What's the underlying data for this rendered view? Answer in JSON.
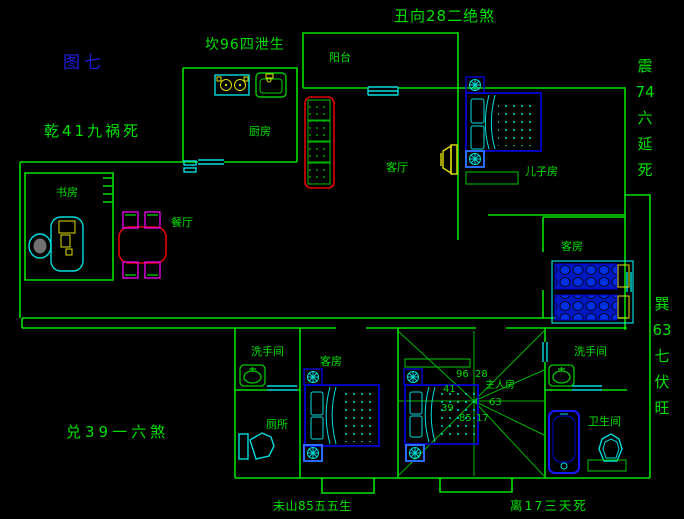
{
  "annotations": {
    "top_center": "丑向28二绝煞",
    "figure_label": "图七",
    "kan_north": "坎96四泄生",
    "qian_northwest": "乾41九祸死",
    "zhen_east": "震\n74\n六\n延\n死",
    "xun_southeast": "巽\n63\n七\n伏\n旺",
    "dui_west": "兑39一六煞",
    "wei_south_left": "未山85五五生",
    "li_south_right": "离17三天死"
  },
  "rooms": {
    "balcony": "阳台",
    "kitchen": "厨房",
    "living_room": "客厅",
    "son_room": "儿子房",
    "study": "书房",
    "dining": "餐厅",
    "guest_room_east": "客房",
    "washroom_left": "洗手间",
    "guest_room_south": "客房",
    "toilet": "厕所",
    "master_room": "主人房",
    "washroom_right": "洗手间",
    "bathroom": "卫生间"
  },
  "compass_numbers": {
    "nw": "96",
    "n": "28",
    "w_upper": "41",
    "w_lower": "39",
    "sw": "85",
    "s": "17",
    "e": "63"
  },
  "colors": {
    "background": "#000000",
    "wall_green": "#00e000",
    "label_blue": "#1e1ee0",
    "furniture_blue": "#0000d2",
    "highlight_blue": "#2a6bff",
    "detail_cyan": "#00dcdc",
    "accent_yellow": "#e0e000",
    "accent_red": "#e00000",
    "accent_magenta": "#e000e0"
  }
}
